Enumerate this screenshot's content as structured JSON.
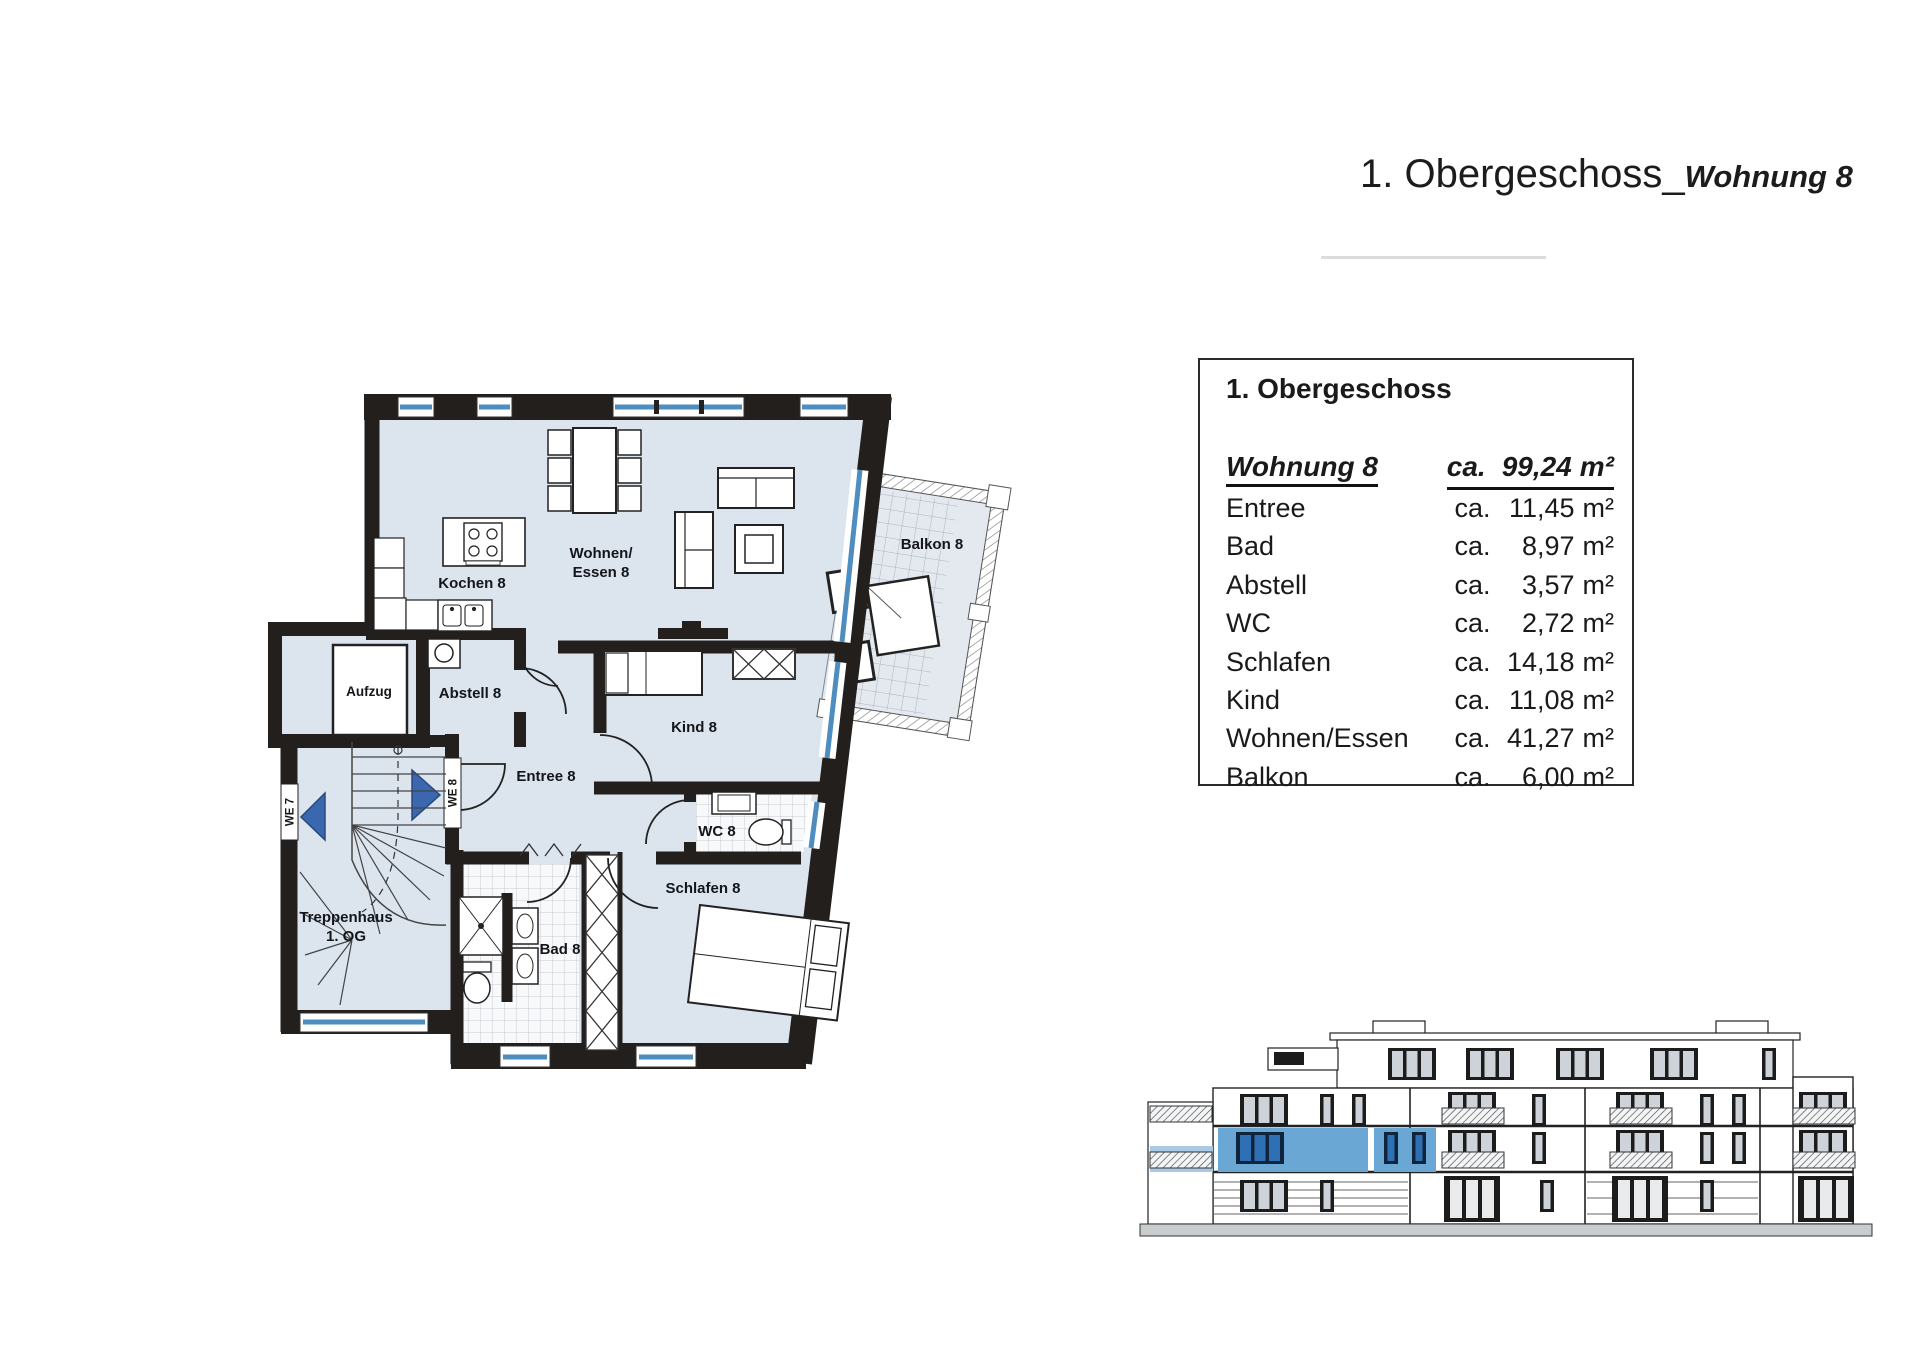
{
  "header": {
    "title_main": "1. Obergeschoss_",
    "title_suffix": "Wohnung 8"
  },
  "summary": {
    "header": "1. Obergeschoss",
    "apartment": {
      "name": "Wohnung 8",
      "prefix": "ca.",
      "value": "99,24",
      "unit": "m²"
    },
    "rows": [
      {
        "room": "Entree",
        "prefix": "ca.",
        "value": "11,45",
        "unit": "m²"
      },
      {
        "room": "Bad",
        "prefix": "ca.",
        "value": "8,97",
        "unit": "m²"
      },
      {
        "room": "Abstell",
        "prefix": "ca.",
        "value": "3,57",
        "unit": "m²"
      },
      {
        "room": "WC",
        "prefix": "ca.",
        "value": "2,72",
        "unit": "m²"
      },
      {
        "room": "Schlafen",
        "prefix": "ca.",
        "value": "14,18",
        "unit": "m²"
      },
      {
        "room": "Kind",
        "prefix": "ca.",
        "value": "11,08",
        "unit": "m²"
      },
      {
        "room": "Wohnen/Essen",
        "prefix": "ca.",
        "value": "41,27",
        "unit": "m²"
      },
      {
        "room": "Balkon",
        "prefix": "ca.",
        "value": "6,00",
        "unit": "m²"
      }
    ]
  },
  "floor_plan": {
    "labels": {
      "wohnen_line1": "Wohnen/",
      "wohnen_line2": "Essen 8",
      "kochen": "Kochen 8",
      "abstell": "Abstell 8",
      "aufzug": "Aufzug",
      "entree": "Entree 8",
      "kind": "Kind 8",
      "wc": "WC 8",
      "schlafen": "Schlafen 8",
      "bad": "Bad 8",
      "trepp_line1": "Treppenhaus",
      "trepp_line2": "1. OG",
      "balkon": "Balkon 8",
      "we7": "WE 7",
      "we8": "WE 8"
    },
    "colors": {
      "room_fill": "#dce4ee",
      "wall": "#221f1d",
      "window_blue": "#4e8dc0",
      "entry_arrow_blue": "#3a67ae"
    }
  },
  "elevation": {
    "colors": {
      "highlight_wall": "#6aa7d5",
      "highlight_window": "#2f6fb4",
      "highlight_light": "#a9c9e4"
    }
  }
}
